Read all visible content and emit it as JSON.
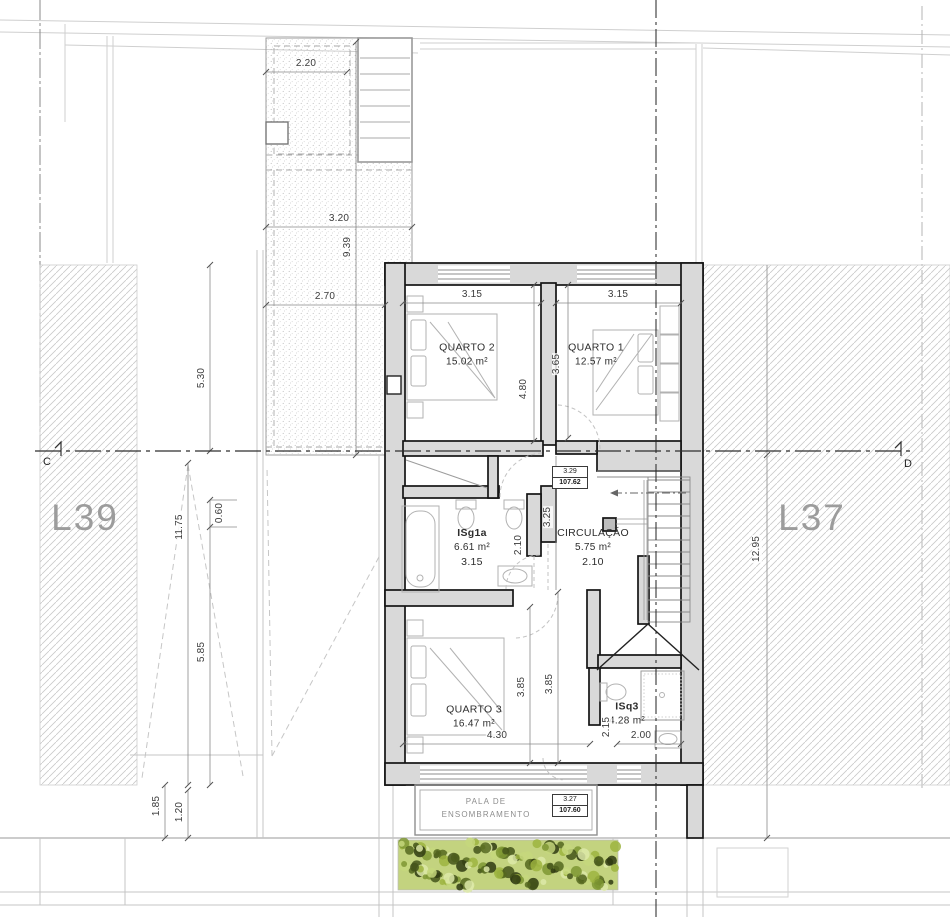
{
  "parcels": {
    "left": "L39",
    "right": "L37"
  },
  "section_markers": {
    "left": "C",
    "right": "D"
  },
  "rooms": [
    {
      "name": "QUARTO 2",
      "area": "15.02 m²"
    },
    {
      "name": "QUARTO 1",
      "area": "12.57 m²"
    },
    {
      "name": "ISg1a",
      "area": "6.61 m²",
      "width_label": "3.15"
    },
    {
      "name": "CIRCULAÇÃO",
      "area": "5.75 m²",
      "width_label": "2.10"
    },
    {
      "name": "QUARTO 3",
      "area": "16.47 m²"
    },
    {
      "name": "ISq3",
      "area": "4.28 m²"
    }
  ],
  "levels": [
    {
      "height": "3.29",
      "elevation": "107.62"
    },
    {
      "height": "3.27",
      "elevation": "107.60"
    }
  ],
  "shading_canopy": {
    "line1": "PALA DE",
    "line2": "ENSOMBRAMENTO"
  },
  "dimensions": {
    "terrace_top": "2.20",
    "terrace_width": "3.20",
    "terrace_height": "9.39",
    "terrace_lower": "2.70",
    "left_upper": "5.30",
    "left_total": "11.75",
    "left_small": "0.60",
    "left_lower": "5.85",
    "bottom_left_outer": "1.85",
    "bottom_left_inner": "1.20",
    "q2_width": "3.15",
    "q1_width": "3.15",
    "q2_depth": "4.80",
    "q1_depth": "3.65",
    "circ_depth": "3.25",
    "isg_depth": "2.10",
    "q3_width": "4.30",
    "q3_depth_a": "3.85",
    "q3_depth_b": "3.85",
    "isq3_depth": "2.15",
    "isq3_width": "2.00",
    "right_total": "12.95"
  },
  "colors": {
    "wall_fill": "#d9d9d9",
    "wall_line": "#141414",
    "hatch": "#c9c9c9",
    "hedge_base": "#b9cc6e",
    "parcel_text": "#9c9c9c"
  }
}
